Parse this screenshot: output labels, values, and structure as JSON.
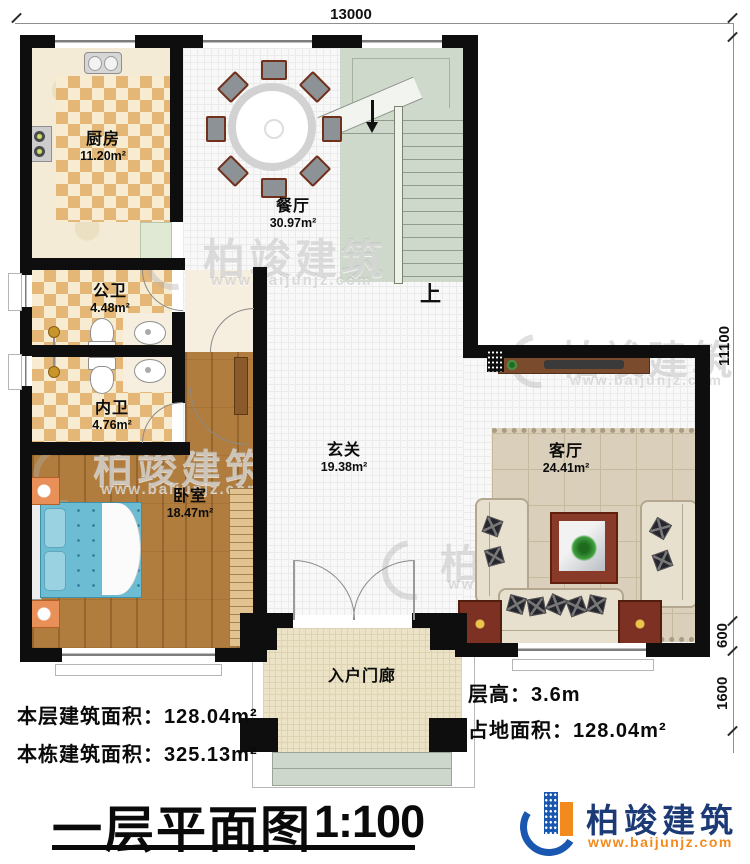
{
  "title": {
    "main": "一层平面图",
    "scale": "1:100"
  },
  "dimensions": {
    "top_width": "13000",
    "right_height": "11100",
    "bay_depth": "600",
    "porch_depth": "1600"
  },
  "rooms": {
    "kitchen": {
      "name": "厨房",
      "area": "11.20m²"
    },
    "dining": {
      "name": "餐厅",
      "area": "30.97m²"
    },
    "public_bath": {
      "name": "公卫",
      "area": "4.48m²"
    },
    "inner_bath": {
      "name": "内卫",
      "area": "4.76m²"
    },
    "bedroom": {
      "name": "卧室",
      "area": "18.47m²"
    },
    "foyer": {
      "name": "玄关",
      "area": "19.38m²"
    },
    "living": {
      "name": "客厅",
      "area": "24.41m²"
    },
    "porch": {
      "name": "入户门廊"
    }
  },
  "stairs": {
    "up_label": "上"
  },
  "info": {
    "floor_label": "本层建筑面积：",
    "floor_value": "128.04m²",
    "total_label": "本栋建筑面积：",
    "total_value": "325.13m²",
    "height_label": "层高：",
    "height_value": "3.6m",
    "footprint_label": "占地面积：",
    "footprint_value": "128.04m²"
  },
  "logo": {
    "name": "柏竣建筑",
    "site": "www.baijunjz.com"
  },
  "watermark": {
    "name": "柏竣建筑",
    "site": "www.baijunjz.com"
  },
  "colors": {
    "wall": "#0e0e0e",
    "logo_navy": "#1c3a75",
    "logo_orange": "#f28a1e",
    "bed": "#6cbcd4",
    "stair": "#cfd9cb"
  }
}
